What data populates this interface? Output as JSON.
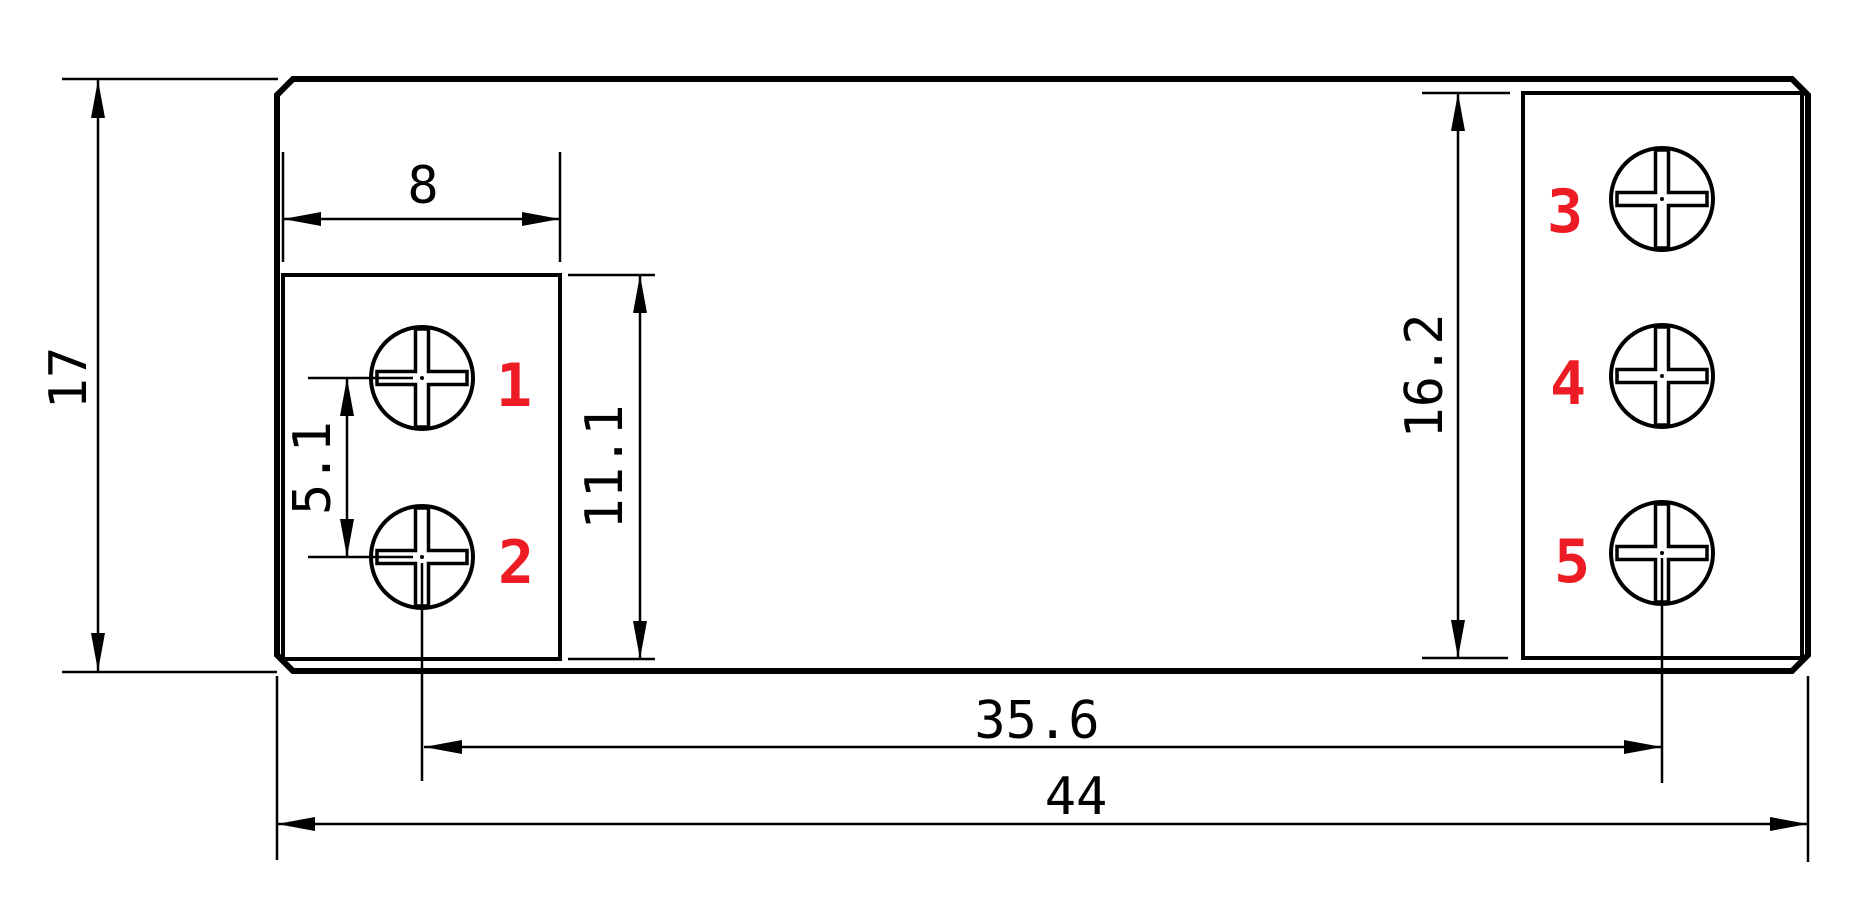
{
  "drawing": {
    "description": "technical dimension drawing of 5-terminal component footprint",
    "line_color": "#000000",
    "label_color": "#ed1c24",
    "background_color": "#ffffff",
    "dimensions": {
      "overall_height": "17",
      "overall_width": "44",
      "hole_pitch_horizontal": "35.6",
      "left_block_width": "8",
      "left_block_height": "11.1",
      "left_hole_pitch": "5.1",
      "right_block_height": "16.2"
    },
    "terminals": [
      {
        "number": "1"
      },
      {
        "number": "2"
      },
      {
        "number": "3"
      },
      {
        "number": "4"
      },
      {
        "number": "5"
      }
    ]
  }
}
